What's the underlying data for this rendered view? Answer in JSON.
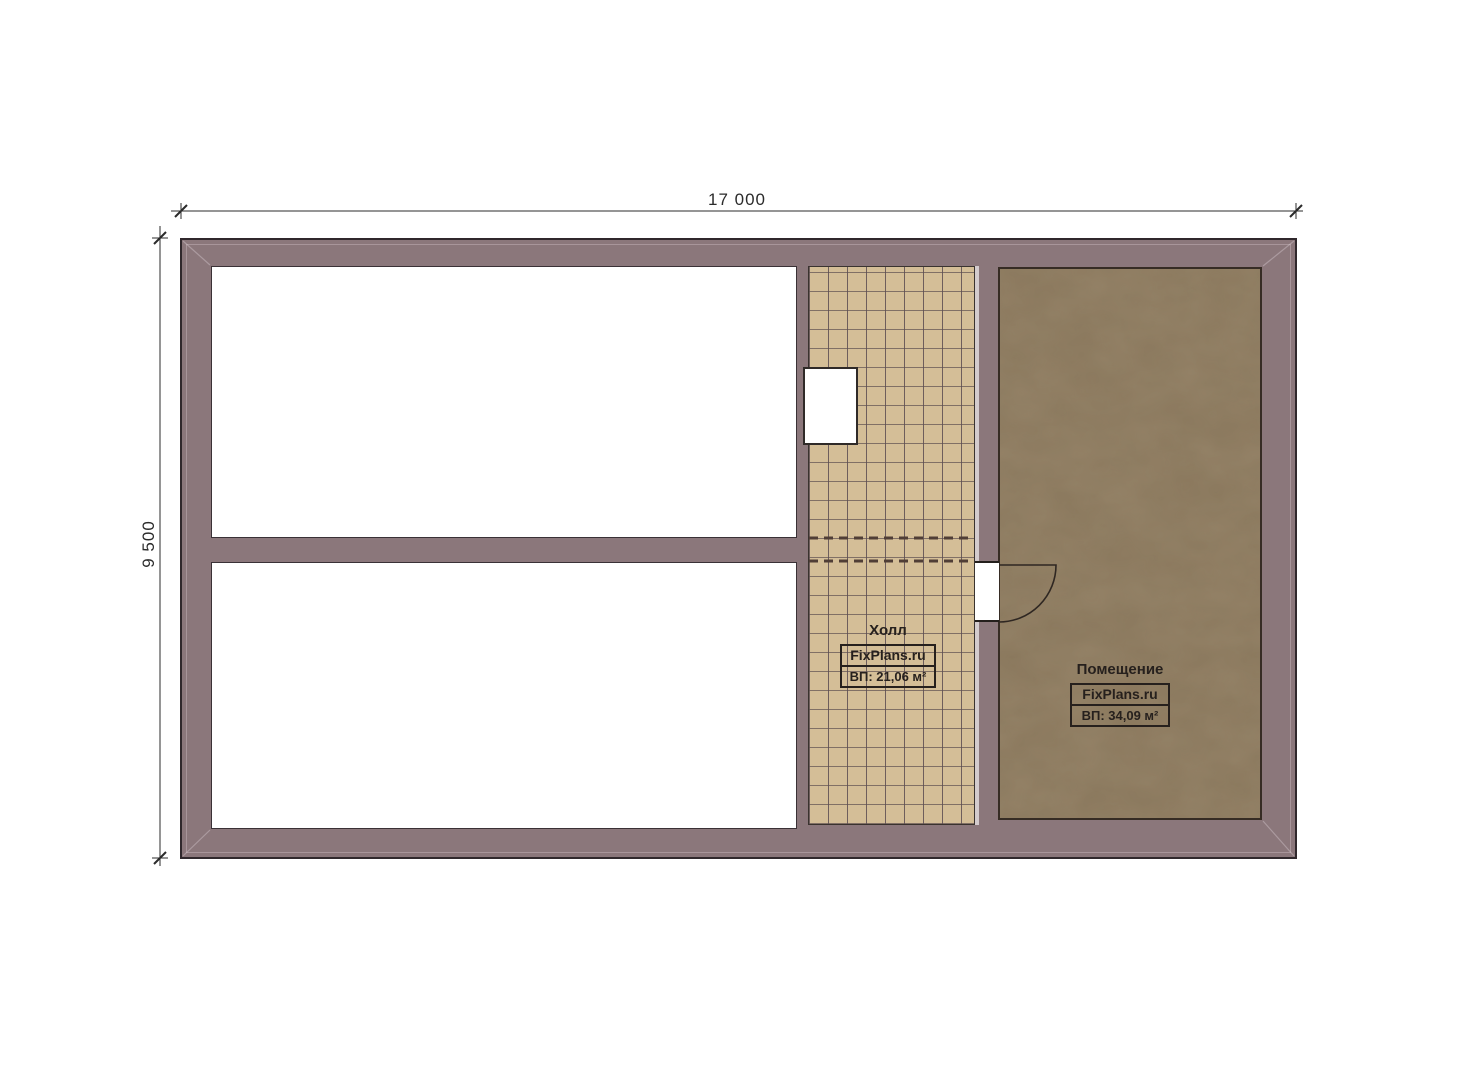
{
  "dimensions": {
    "top_label": "17 000",
    "left_label": "9 500"
  },
  "labels": {
    "hall": {
      "title": "Холл",
      "brand": "FixPlans.ru",
      "area": "ВП: 21,06 м²"
    },
    "main_room": {
      "title": "Помещение",
      "brand": "FixPlans.ru",
      "area": "ВП: 34,09 м²"
    }
  },
  "colors": {
    "wall_fill": "#8b777b",
    "wall_outline": "#30282c",
    "tile_floor": "#d4be97",
    "main_room_floor": "#8d7a5f",
    "dimension_ink": "#2b2b2b",
    "label_ink": "#26201d",
    "door_ink": "#2f2722"
  }
}
